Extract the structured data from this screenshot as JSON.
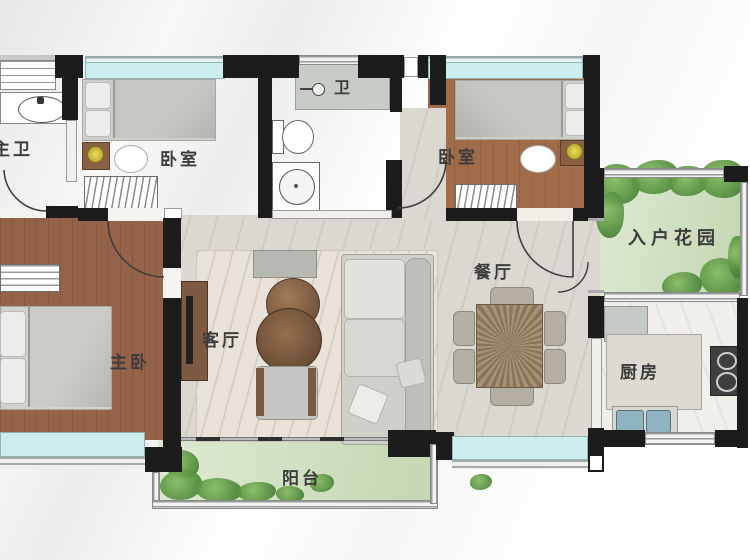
{
  "rooms": {
    "master_bath": {
      "label": "主卫"
    },
    "bedroom_1": {
      "label": "卧室"
    },
    "bathroom": {
      "label": "卫"
    },
    "bedroom_2": {
      "label": "卧室"
    },
    "entry_garden": {
      "label": "入户花园"
    },
    "living_room": {
      "label": "客厅"
    },
    "dining_room": {
      "label": "餐厅"
    },
    "kitchen": {
      "label": "厨房"
    },
    "master_bedroom": {
      "label": "主卧"
    },
    "balcony": {
      "label": "阳台"
    }
  },
  "colors": {
    "wall": "#1c1c1c",
    "window_glass": "#cdeeee",
    "wood_floor": "#9c6a4b",
    "tile_floor": "#dbd7d1",
    "bath_floor": "#e2dccf",
    "garden_floor": "#d2e2c2",
    "plant_green": "#4f8a3c",
    "kitchen_floor": "#f0efea",
    "label_text": "#3c3c3c"
  }
}
